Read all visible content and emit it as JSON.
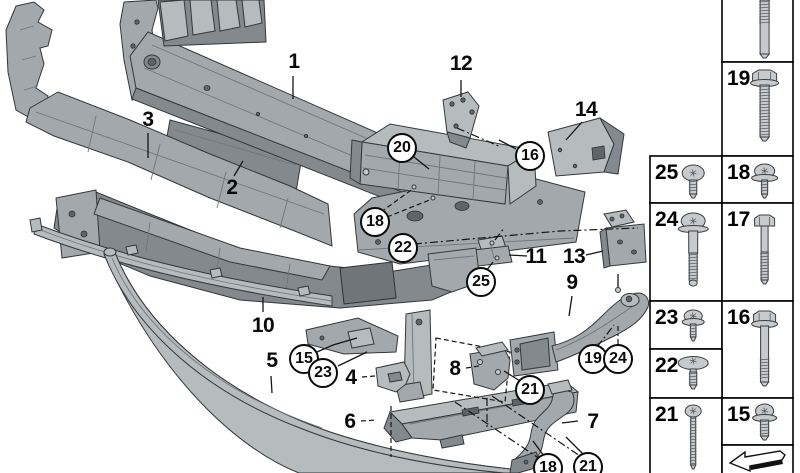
{
  "meta": {
    "description": "Exploded technical parts diagram of a front bumper carrier / mounting hardware with numbered callouts and fastener reference table",
    "background": "#ffffff",
    "line_color": "#0a0a0a"
  },
  "diagram": {
    "plain_callouts": [
      {
        "id": "1",
        "x": 294,
        "y": 62
      },
      {
        "id": "2",
        "x": 232,
        "y": 188
      },
      {
        "id": "3",
        "x": 148,
        "y": 120
      },
      {
        "id": "4",
        "x": 351,
        "y": 378
      },
      {
        "id": "5",
        "x": 272,
        "y": 361
      },
      {
        "id": "6",
        "x": 350,
        "y": 422
      },
      {
        "id": "7",
        "x": 593,
        "y": 422
      },
      {
        "id": "8",
        "x": 455,
        "y": 369
      },
      {
        "id": "9",
        "x": 572,
        "y": 283
      },
      {
        "id": "10",
        "x": 263,
        "y": 326
      },
      {
        "id": "11",
        "x": 536,
        "y": 257
      },
      {
        "id": "12",
        "x": 461,
        "y": 64
      },
      {
        "id": "13",
        "x": 574,
        "y": 257
      },
      {
        "id": "14",
        "x": 586,
        "y": 110
      }
    ],
    "circled_callouts": [
      {
        "id": "20",
        "x": 402,
        "y": 148
      },
      {
        "id": "16",
        "x": 530,
        "y": 156
      },
      {
        "id": "18",
        "x": 375,
        "y": 222
      },
      {
        "id": "22",
        "x": 403,
        "y": 248
      },
      {
        "id": "25",
        "x": 481,
        "y": 282
      },
      {
        "id": "15",
        "x": 304,
        "y": 359
      },
      {
        "id": "23",
        "x": 323,
        "y": 373
      },
      {
        "id": "21",
        "x": 530,
        "y": 390
      },
      {
        "id": "19",
        "x": 593,
        "y": 359
      },
      {
        "id": "24",
        "x": 618,
        "y": 359
      },
      {
        "id": "18",
        "x": 548,
        "y": 468
      },
      {
        "id": "21",
        "x": 588,
        "y": 467
      }
    ]
  },
  "parts_table": {
    "cells": [
      {
        "number": "",
        "fastener": "stud-bolt-cut",
        "x": 722,
        "y": 0,
        "w": 71,
        "h": 62,
        "clip_top": true
      },
      {
        "number": "19",
        "fastener": "hex-flange-bolt-long",
        "x": 722,
        "y": 62,
        "w": 71,
        "h": 94
      },
      {
        "number": "25",
        "fastener": "pan-head-screw",
        "x": 650,
        "y": 156,
        "w": 72,
        "h": 47
      },
      {
        "number": "18",
        "fastener": "washer-screw",
        "x": 722,
        "y": 156,
        "w": 71,
        "h": 47
      },
      {
        "number": "24",
        "fastener": "shoulder-screw-long",
        "x": 650,
        "y": 203,
        "w": 72,
        "h": 98
      },
      {
        "number": "17",
        "fastener": "hex-bolt",
        "x": 722,
        "y": 203,
        "w": 71,
        "h": 98
      },
      {
        "number": "23",
        "fastener": "washer-screw-small",
        "x": 650,
        "y": 301,
        "w": 72,
        "h": 48
      },
      {
        "number": "16",
        "fastener": "hex-flange-bolt",
        "x": 722,
        "y": 301,
        "w": 71,
        "h": 97
      },
      {
        "number": "22",
        "fastener": "mushroom-screw",
        "x": 650,
        "y": 349,
        "w": 72,
        "h": 49
      },
      {
        "number": "21",
        "fastener": "thin-screw-long",
        "x": 650,
        "y": 398,
        "w": 72,
        "h": 75,
        "clip_bottom": true
      },
      {
        "number": "15",
        "fastener": "washer-screw-stub",
        "x": 722,
        "y": 398,
        "w": 71,
        "h": 47
      },
      {
        "number": "",
        "fastener": "direction-arrow",
        "x": 722,
        "y": 445,
        "w": 71,
        "h": 28,
        "clip_bottom": true
      }
    ]
  }
}
